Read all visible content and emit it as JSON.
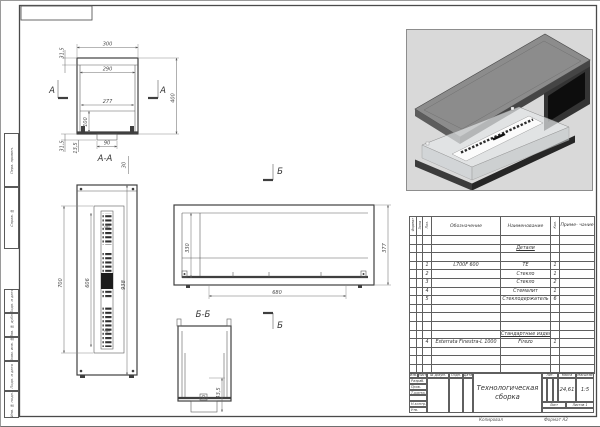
{
  "sheet": {
    "kopiroval": "Копировал",
    "format": "Формат А2"
  },
  "stamps": [
    "Перв. примен.",
    "Справ. №",
    "Подп. и дата",
    "Инв. № дубл.",
    "Взам. инв. №",
    "Подп. и дата",
    "Инв. № подл."
  ],
  "views": {
    "marks": {
      "a": "А",
      "b": "Б"
    },
    "front": {
      "d300": "300",
      "d290": "290",
      "d277": "277",
      "d400": "400",
      "d315_top": "31,5",
      "d100": "100",
      "d315_bot": "31,5",
      "d135": "13,5",
      "d90": "90"
    },
    "section_aa": {
      "label": "А-А",
      "d30": "30",
      "d700": "700",
      "d606": "606",
      "d938": "938"
    },
    "side": {
      "d330": "330",
      "d377": "377",
      "d680": "680"
    },
    "section_bb": {
      "label": "Б-Б",
      "d435": "43,5"
    }
  },
  "spec_table": {
    "headers": {
      "format": "Формат",
      "zone": "Зона",
      "pos": "Поз.",
      "designation": "Обозначение",
      "name": "Наименование",
      "qty": "Кол.",
      "note": "Приме-\nчание"
    },
    "sections": {
      "details": "Детали",
      "standard": "Стандартные изделия"
    },
    "rows": [
      {
        "pos": "1",
        "designation": "L700F 600",
        "name": "ТЕ",
        "qty": "1"
      },
      {
        "pos": "2",
        "designation": "",
        "name": "Стекло",
        "qty": "1"
      },
      {
        "pos": "3",
        "designation": "",
        "name": "Стекло",
        "qty": "2"
      },
      {
        "pos": "4",
        "designation": "",
        "name": "Стемалит",
        "qty": "1"
      },
      {
        "pos": "5",
        "designation": "",
        "name": "Стеклодержатель",
        "qty": "6"
      }
    ],
    "standard_rows": [
      {
        "pos": "4",
        "designation": "Esterrata Finestra-L 1000",
        "name": "Firezo",
        "qty": "1"
      }
    ]
  },
  "title_block": {
    "title": "Технологическая сборка",
    "header_cols": {
      "izm": "Изм.",
      "list": "Лист",
      "doc": "№ докум.",
      "sign": "Подп.",
      "date": "Дата"
    },
    "row_labels": {
      "razrab": "Разраб.",
      "prov": "Пров.",
      "tkontr": "Т.контр.",
      "nkontr": "Н.контр.",
      "utv": "Утв."
    },
    "lit_label": "Лит.",
    "mass_label": "Масса",
    "scale_label": "Масштаб",
    "mass_value": "24,61",
    "scale_value": "1:5",
    "sheet_label": "Лист",
    "sheets_label": "Листов",
    "sheets_value": "1"
  }
}
